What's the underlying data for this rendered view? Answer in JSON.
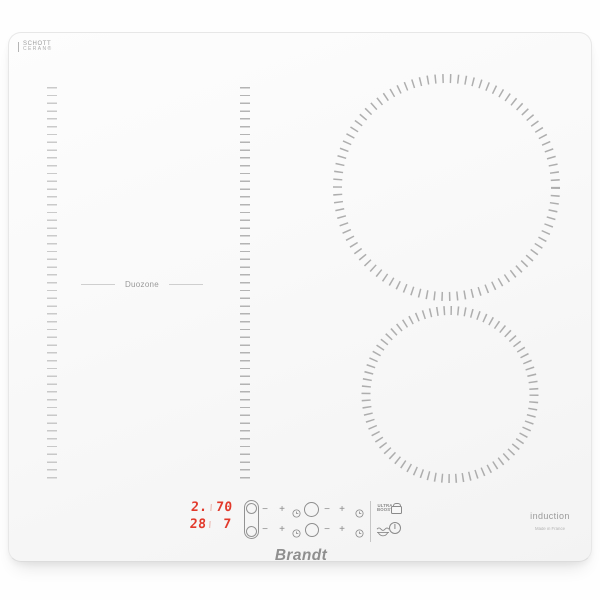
{
  "product": {
    "glass_brand": {
      "line1": "SCHOTT",
      "line2": "CERAN®"
    },
    "brand_logo": "Brandt",
    "technology_label": "induction",
    "origin_label": "Made in France"
  },
  "left_zone": {
    "label": "Duozone"
  },
  "display": {
    "rows": [
      {
        "left": "2.",
        "right": "70"
      },
      {
        "left": "28",
        "right": "7"
      }
    ],
    "led_color": "#e2392b"
  },
  "controls": {
    "minus": "−",
    "plus": "+",
    "ultra_boost": {
      "line1": "ULTRA",
      "line2": "BOOST"
    },
    "icons": {
      "left_dual_zone_selector": "dual-zone-icon",
      "right_top_zone_selector": "zone-circle-icon",
      "right_bottom_zone_selector": "zone-circle-icon",
      "timer": "clock-icon",
      "lock": "padlock-icon",
      "keep_warm": "keep-warm-icon",
      "power": "power-icon"
    }
  },
  "colors": {
    "icon_gray": "#8a8a8a",
    "tick_gray": "#9b9b9b",
    "surface": "#f8f8f8",
    "led_red": "#e2392b"
  }
}
